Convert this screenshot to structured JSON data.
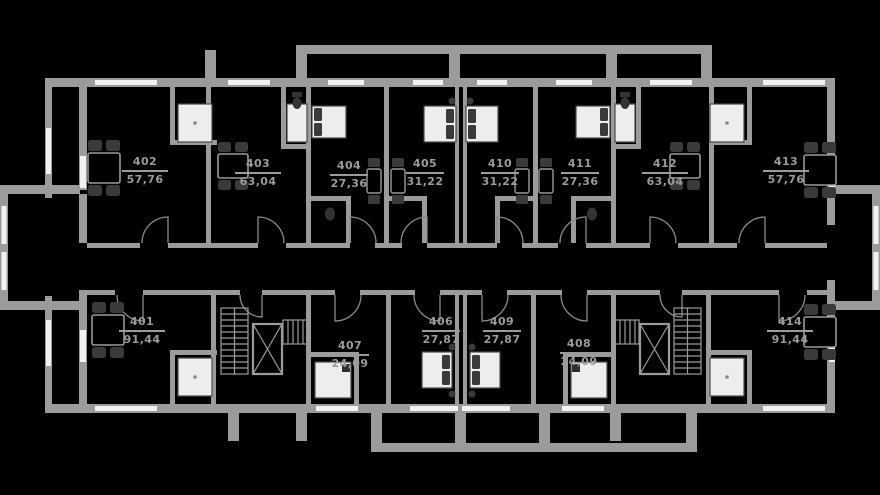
{
  "plan": {
    "type": "residential-floor-plan",
    "units": [
      {
        "number": "401",
        "area": "91,44"
      },
      {
        "number": "402",
        "area": "57,76"
      },
      {
        "number": "403",
        "area": "63,04"
      },
      {
        "number": "404",
        "area": "27,36"
      },
      {
        "number": "405",
        "area": "31,22"
      },
      {
        "number": "406",
        "area": "27,87"
      },
      {
        "number": "407",
        "area": "24,09"
      },
      {
        "number": "408",
        "area": "24,09"
      },
      {
        "number": "409",
        "area": "27,87"
      },
      {
        "number": "410",
        "area": "31,22"
      },
      {
        "number": "411",
        "area": "27,36"
      },
      {
        "number": "412",
        "area": "63,04"
      },
      {
        "number": "413",
        "area": "57,76"
      },
      {
        "number": "414",
        "area": "91,44"
      }
    ],
    "colors": {
      "background": "#000000",
      "wall": "#9b9b9b",
      "label_text": "#9b9b9b",
      "furniture_dark": "#3a3a3a",
      "fixture_white": "#ededed"
    }
  }
}
